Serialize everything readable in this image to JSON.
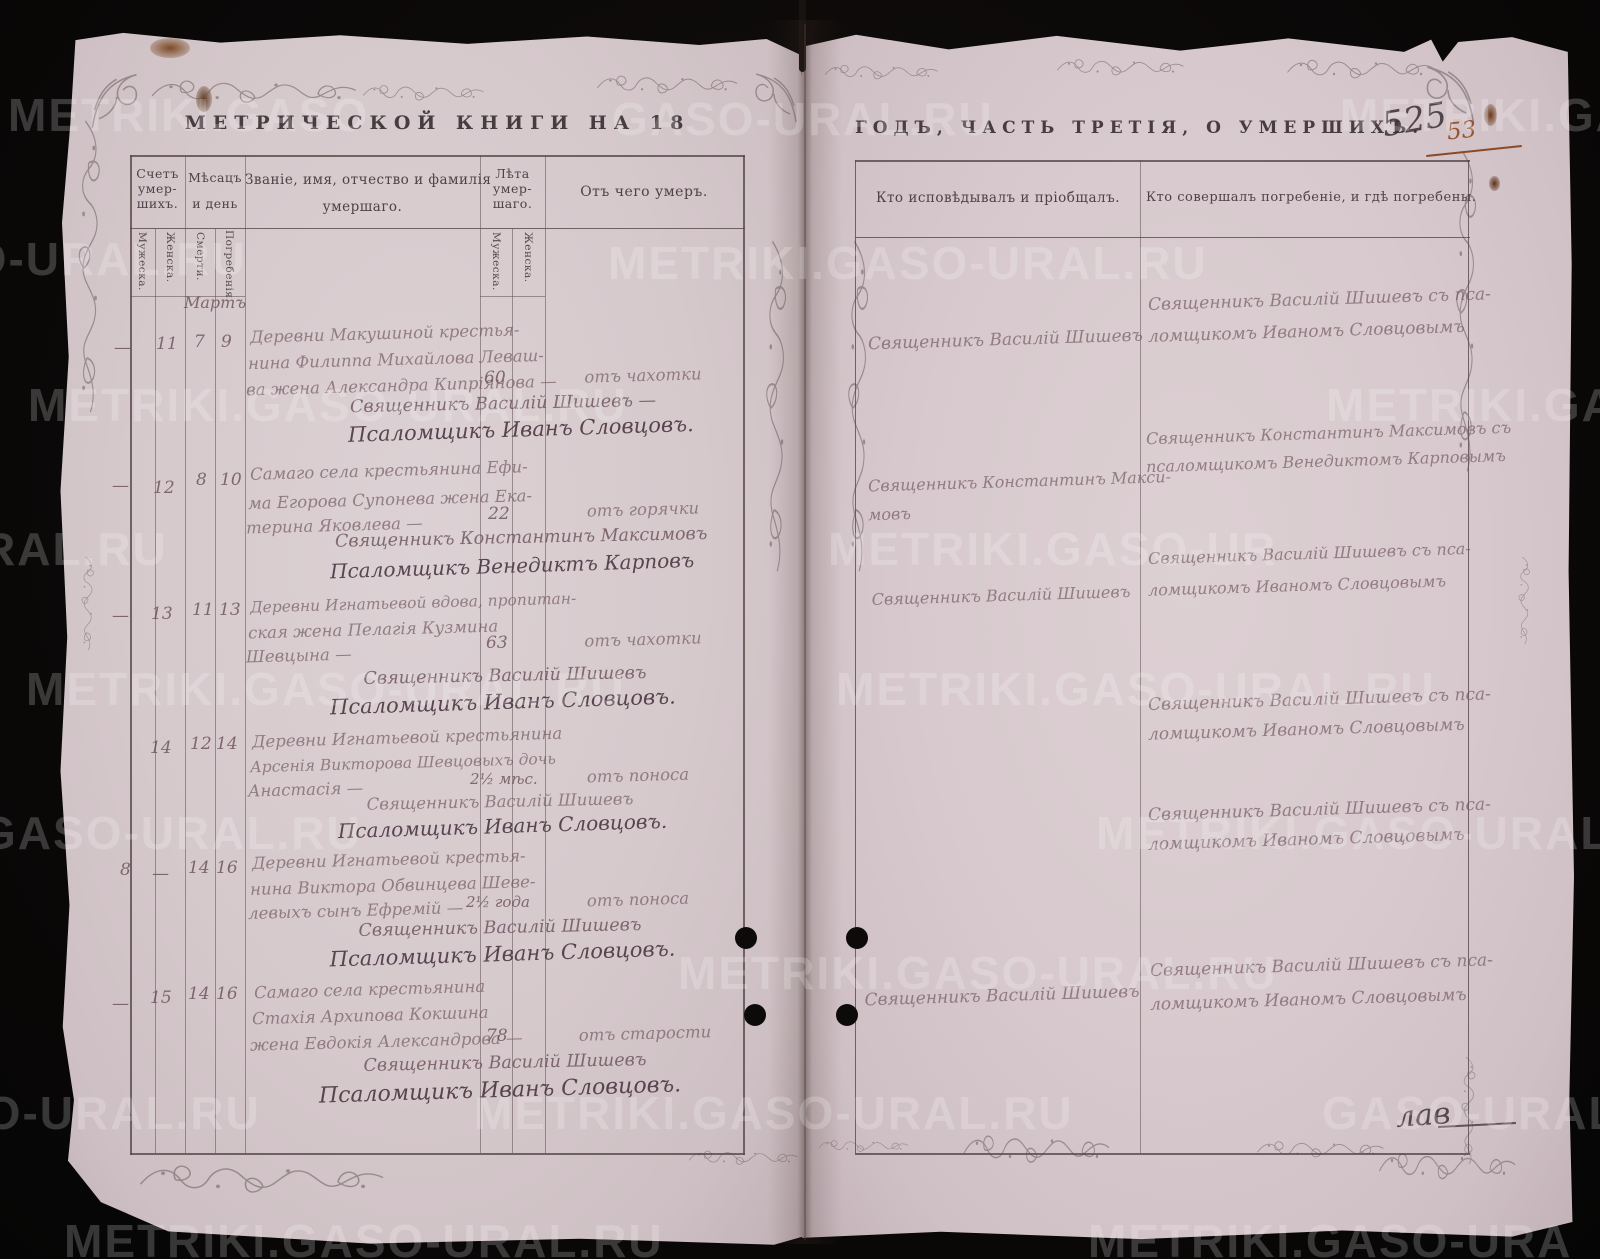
{
  "watermark": {
    "text": "METRIKI.GASO-URAL.RU",
    "fragments": [
      "METRIKI.GASO",
      "GASO-URAL.RU",
      "METRIKI.GA",
      "SO-URAL.RU",
      "METRIKI.GASO-URAL.RU",
      "METRIKI.GASO-URAL.RU",
      "METRIKI.GASO",
      "RAL.RU",
      "METRIKI.GASO-UR",
      "METRIKI.GASO-URAL.RU",
      "METRIKI.GASO-URAL.RU",
      "GASO-URAL.RU",
      "METRIKI.GASO-URAL",
      "METRIKI.GASO-URAL.RU",
      "SO-URAL.RU",
      "METRIKI.GASO-URAL.RU",
      "GASO-URAL.RU",
      "METRIKI.GASO-URAL.RU",
      "METRIKI.GASO-URA"
    ]
  },
  "left": {
    "title": "МЕТРИЧЕСКОЙ КНИГИ НА 18",
    "headers": {
      "count1": "Счетъ",
      "count2": "умер-",
      "count3": "шихъ.",
      "month1": "Мѣсацъ",
      "month2": "и день",
      "name1": "Званіе, имя, отчество и фамилія",
      "name2": "умершаго.",
      "age1": "Лѣта",
      "age2": "умер-",
      "age3": "шаго.",
      "cause": "Отъ чего умеръ.",
      "sub_male1": "Мужеска.",
      "sub_female1": "Женска.",
      "sub_death": "Смерти.",
      "sub_burial": "Погребенія.",
      "sub_male2": "Мужеска.",
      "sub_female2": "Женска."
    },
    "month_label": "Мартъ",
    "entries": [
      {
        "male": "—",
        "female": "11",
        "death": "7",
        "burial": "9",
        "desc": [
          "Деревни Макушиной крестья-",
          "нина Филиппа Михайлова Леваш-",
          "ва жена Александра Кипріянова —"
        ],
        "age": "60",
        "cause": "отъ чахотки",
        "clergy1": "Священникъ Василій Шишевъ —",
        "clergy2": "Псаломщикъ Иванъ Словцовъ."
      },
      {
        "male": "—",
        "female": "12",
        "death": "8",
        "burial": "10",
        "desc": [
          "Самаго села крестьянина Ефи-",
          "ма Егорова Супонева жена Ека-",
          "терина Яковлева —"
        ],
        "age": "22",
        "cause": "отъ горячки",
        "clergy1": "Священникъ Константинъ Максимовъ",
        "clergy2": "Псаломщикъ Венедиктъ Карповъ"
      },
      {
        "male": "—",
        "female": "13",
        "death": "11",
        "burial": "13",
        "desc": [
          "Деревни Игнатьевой вдова, пропитан-",
          "ская жена Пелагія Кузмина",
          "Шевцына —"
        ],
        "age": "63",
        "cause": "отъ чахотки",
        "clergy1": "Священникъ Василій Шишевъ",
        "clergy2": "Псаломщикъ Иванъ Словцовъ."
      },
      {
        "male": "",
        "female": "14",
        "death": "12",
        "burial": "14",
        "desc": [
          "Деревни Игнатьевой крестьянина",
          "Арсенія Викторова Шевцовыхъ дочь",
          "Анастасія —"
        ],
        "age": "2½ мѣс.",
        "cause": "отъ поноса",
        "clergy1": "Священникъ Василій Шишевъ",
        "clergy2": "Псаломщикъ Иванъ Словцовъ."
      },
      {
        "male": "8",
        "female": "—",
        "death": "14",
        "burial": "16",
        "desc": [
          "Деревни Игнатьевой крестья-",
          "нина Виктора Обвинцева Шеве-",
          "левыхъ сынъ Ефремій —"
        ],
        "age": "2½ года",
        "cause": "отъ поноса",
        "clergy1": "Священникъ Василій Шишевъ",
        "clergy2": "Псаломщикъ Иванъ Словцовъ."
      },
      {
        "male": "—",
        "female": "15",
        "death": "14",
        "burial": "16",
        "desc": [
          "Самаго села крестьянина",
          "Стахія Архипова Кокшина",
          "жена Евдокія Александрова —"
        ],
        "age": "78",
        "cause": "отъ старости",
        "clergy1": "Священникъ Василій Шишевъ",
        "clergy2": "Псаломщикъ Иванъ Словцовъ."
      }
    ]
  },
  "right": {
    "title": "ГОДЪ, ЧАСТЬ ТРЕТІЯ, О УМЕРШИХЪ.",
    "page_number_old": "525",
    "page_number_new": "53",
    "col_confessor": "Кто исповѣдывалъ и пріобщалъ.",
    "col_burial": "Кто совершалъ погребеніе, и гдѣ погребены.",
    "entries": [
      {
        "confessor": [
          "Священникъ Василій Шишевъ"
        ],
        "burial": [
          "Священникъ Василій Шишевъ съ пса-",
          "ломщикомъ Иваномъ Словцовымъ"
        ]
      },
      {
        "confessor": [
          "Священникъ Константинъ Макси-",
          "мовъ"
        ],
        "burial": [
          "Священникъ Константинъ Максимовъ съ",
          "псаломщикомъ Венедиктомъ Карповымъ"
        ]
      },
      {
        "confessor": [
          "Священникъ Василій Шишевъ"
        ],
        "burial": [
          "Священникъ Василій Шишевъ съ пса-",
          "ломщикомъ Иваномъ Словцовымъ"
        ]
      },
      {
        "confessor": [],
        "burial": [
          "Священникъ Василій Шишевъ съ пса-",
          "ломщикомъ Иваномъ Словцовымъ"
        ]
      },
      {
        "confessor": [],
        "burial": [
          "Священникъ Василій Шишевъ съ пса-",
          "ломщикомъ Иваномъ Словцовымъ"
        ]
      },
      {
        "confessor": [
          "Священникъ Василій Шишевъ"
        ],
        "burial": [
          "Священникъ Василій Шишевъ съ пса-",
          "ломщикомъ Иваномъ Словцовымъ"
        ]
      }
    ],
    "margin_note": "лав"
  }
}
